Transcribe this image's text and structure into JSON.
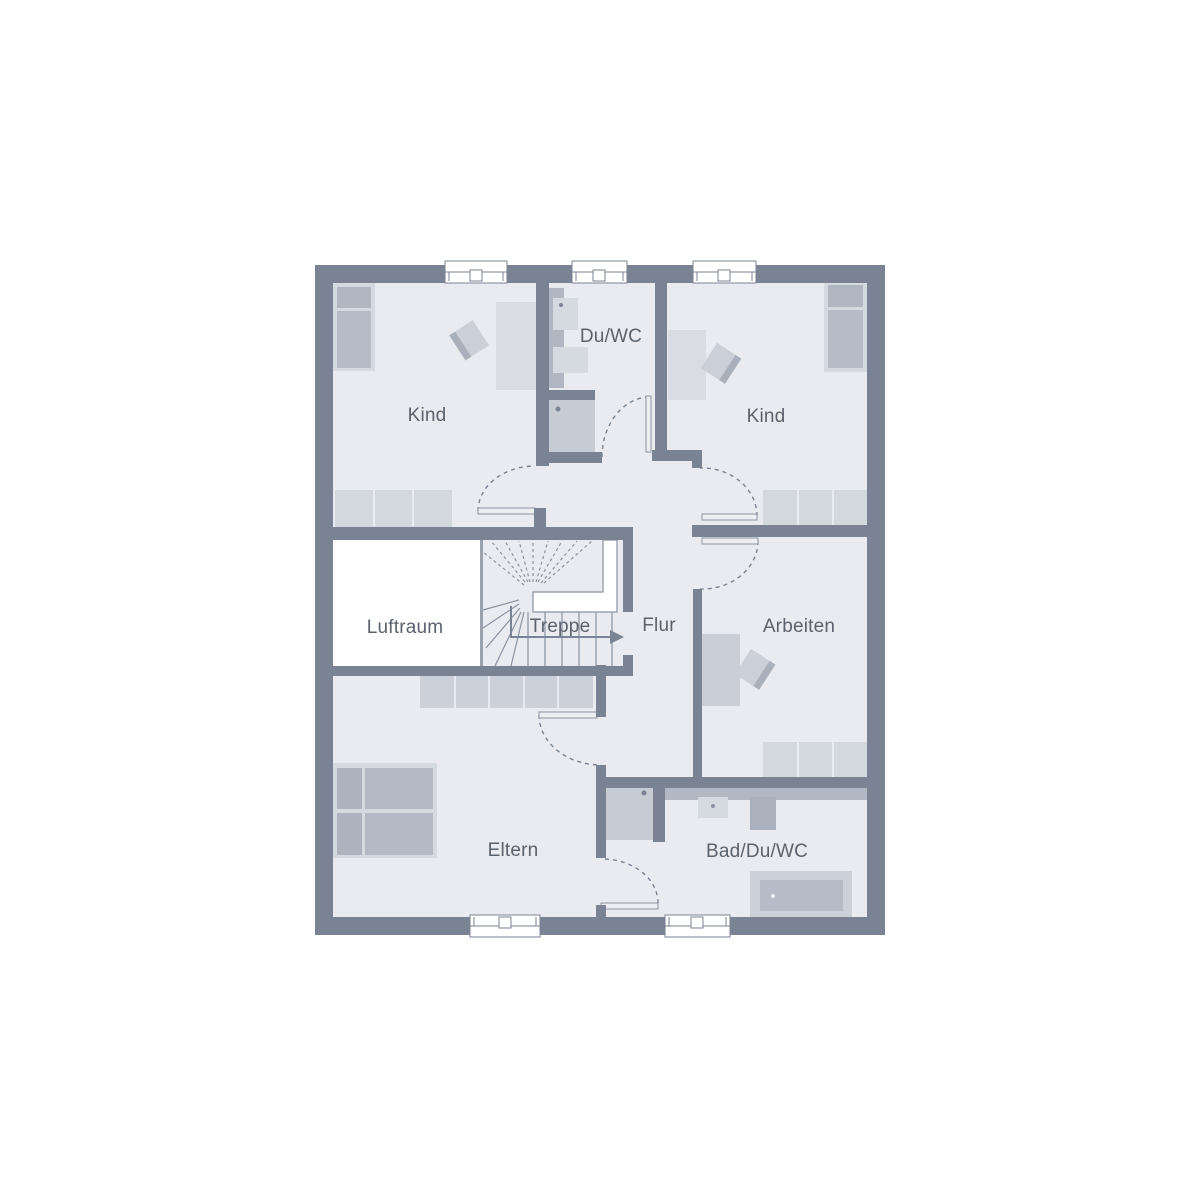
{
  "plan": {
    "kind": "residential-floor-plan",
    "language": "de"
  },
  "rooms": [
    {
      "id": "kind-left",
      "label": "Kind"
    },
    {
      "id": "du-wc",
      "label": "Du/WC"
    },
    {
      "id": "kind-right",
      "label": "Kind"
    },
    {
      "id": "luftraum",
      "label": "Luftraum"
    },
    {
      "id": "treppe",
      "label": "Treppe"
    },
    {
      "id": "flur",
      "label": "Flur"
    },
    {
      "id": "arbeiten",
      "label": "Arbeiten"
    },
    {
      "id": "eltern",
      "label": "Eltern"
    },
    {
      "id": "bad-du-wc",
      "label": "Bad/Du/WC"
    }
  ],
  "counts": {
    "windows_top": 3,
    "windows_bottom": 2,
    "doors": 6
  },
  "colors": {
    "wall": "#7a8393",
    "floor": "#e9ebf0",
    "void_white": "#ffffff",
    "furniture_light": "#d5d9e0",
    "furniture_medium": "#c6cbd4",
    "furniture_dark": "#b0b7c2",
    "thin_line": "#8a93a1",
    "text": "#5c626d"
  }
}
